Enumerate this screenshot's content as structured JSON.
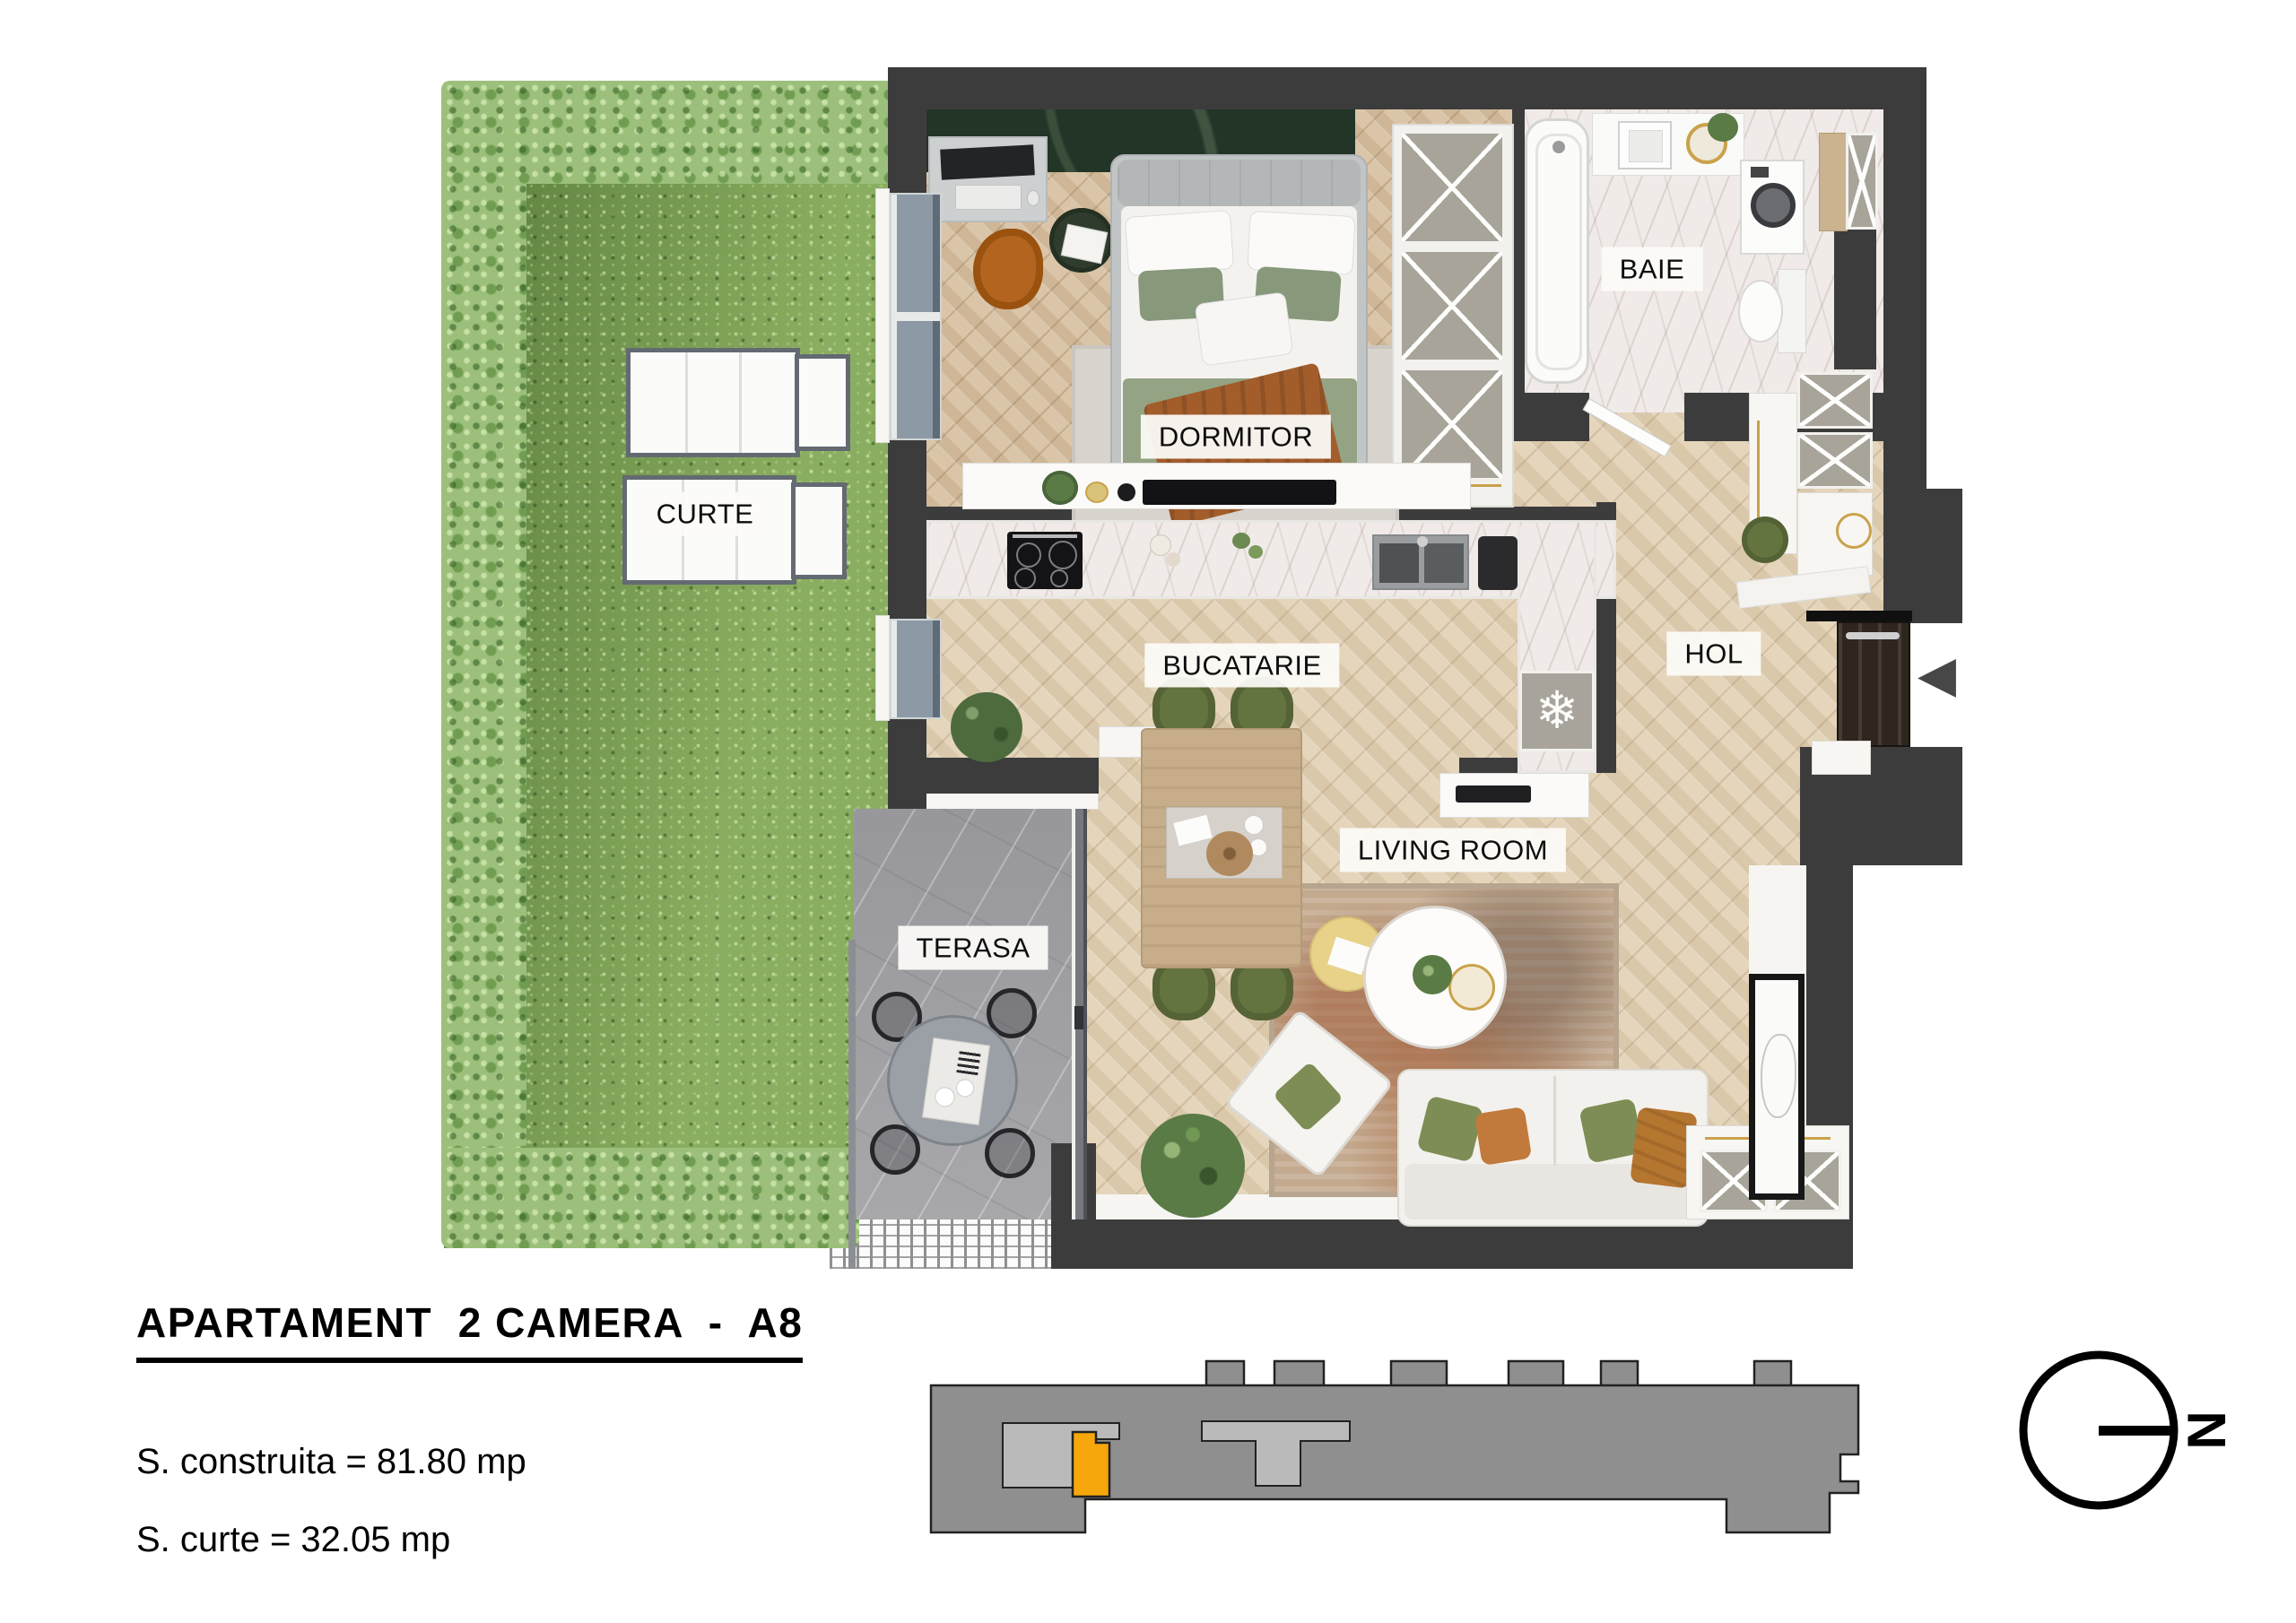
{
  "document": {
    "type": "apartment-floor-plan"
  },
  "info_block": {
    "title": "APARTAMENT  2 CAMERA  -  A8",
    "areas": [
      {
        "label": "S. construita",
        "value": "81.80",
        "unit": "mp",
        "text": "S. construita = 81.80 mp"
      },
      {
        "label": "S. curte",
        "value": "32.05",
        "unit": "mp",
        "text": "S. curte = 32.05 mp"
      }
    ]
  },
  "rooms": [
    {
      "id": "dormitor",
      "label": "DORMITOR"
    },
    {
      "id": "baie",
      "label": "BAIE"
    },
    {
      "id": "curte",
      "label": "CURTE"
    },
    {
      "id": "bucatarie",
      "label": "BUCATARIE"
    },
    {
      "id": "hol",
      "label": "HOL"
    },
    {
      "id": "terasa",
      "label": "TERASA"
    },
    {
      "id": "living",
      "label": "LIVING ROOM"
    }
  ],
  "compass": {
    "north_label": "N"
  },
  "icons": {
    "snowflake": "❄",
    "entrance_arrow": "◀"
  },
  "locator": {
    "highlighted_unit": "A8"
  },
  "colors": {
    "wall": "#3c3c3c",
    "floor": "#e3d2b6",
    "floor-bedroom": "#d8c1a1",
    "grass": "#74994f",
    "hedge": "#9cc07b",
    "terrace": "#a3a3a7",
    "marble": "#f0ebe8",
    "accent-orange": "#F6A70B",
    "building-gray": "#8f8f8f",
    "building-light": "#bababa",
    "door-brown": "#2f261e",
    "headboard-green": "#223527",
    "chair-green": "#64743f",
    "pillow-green": "#7d8d55",
    "rust": "#a35d2b",
    "gold": "#c9a24b"
  }
}
